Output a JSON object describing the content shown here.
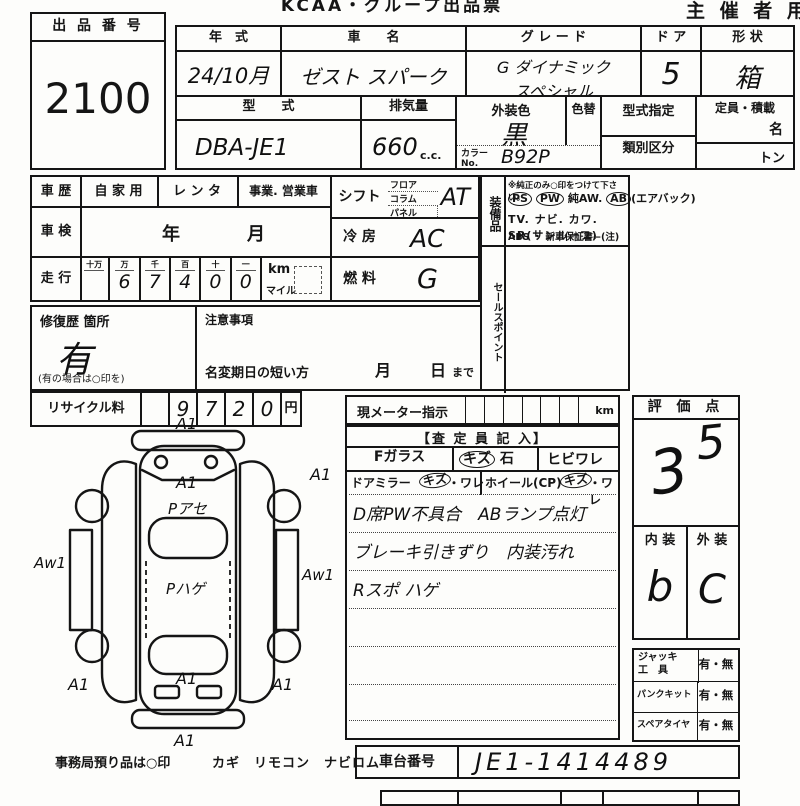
{
  "colors": {
    "ink": "#151515",
    "paper": "#fdfdfb"
  },
  "header": {
    "title": "KCAA・グループ出品票",
    "organizer": "主 催 者 用"
  },
  "lot": {
    "label": "出 品 番 号",
    "number": "2100"
  },
  "top": {
    "year_label": "年　式",
    "year_value": "24/10月",
    "name_label": "車　　名",
    "name_value": "ゼスト スパーク",
    "grade_label": "グ レ ー ド",
    "grade_line1": "G ダイナミック",
    "grade_line2": "スペシャル",
    "door_label": "ド ア",
    "door_value": "5",
    "shape_label": "形 状",
    "shape_value": "箱",
    "model_label": "型　　式",
    "model_value": "DBA-JE1",
    "disp_label": "排気量",
    "disp_value": "660",
    "disp_unit": "c.c.",
    "color_label": "外装色",
    "color_value": "黒",
    "recolor_label": "色替",
    "colorno_label": "カラーNo.",
    "colorno_value": "B92P",
    "typedesig_label": "型式指定",
    "class_label": "類別区分",
    "capacity_label": "定員・積載",
    "capacity_persons": "名",
    "capacity_load": "トン"
  },
  "history": {
    "label": "車 歴",
    "opt1": "自 家 用",
    "opt2": "レ ン タ",
    "opt3": "事業. 営業車"
  },
  "shaken": {
    "label": "車 検",
    "year": "年",
    "month": "月"
  },
  "mileage": {
    "label": "走 行",
    "cols": [
      "十万",
      "万",
      "千",
      "百",
      "十",
      "一"
    ],
    "digits": [
      "",
      "6",
      "7",
      "4",
      "0",
      "0"
    ],
    "km": "km",
    "mile": "マイル"
  },
  "shift": {
    "label": "シフト",
    "opt1": "フロア",
    "opt2": "コラム",
    "opt3": "パネル",
    "value": "AT"
  },
  "cooling": {
    "label": "冷 房",
    "value": "AC"
  },
  "fuel": {
    "label": "燃 料",
    "value": "G"
  },
  "equipment": {
    "label": "装備品",
    "note": "※純正のみ○印をつけて下さい。",
    "ps": "PS",
    "pw": "PW",
    "aw": "純AW.",
    "ab": "AB",
    "ab_suffix": "(エアバック)",
    "line2": "TV. ナビ. カワ. SR(サンルーフ)",
    "line3": "ABS ・ 新車保証書←(注) 後日送りのみ"
  },
  "salespoint": {
    "label": "セールスポイント"
  },
  "repair": {
    "label": "修復歴 箇所",
    "value": "有",
    "note": "(有の場合は○印を)"
  },
  "caution": {
    "label": "注意事項",
    "line": "名変期日の短い方",
    "month": "月",
    "day": "日",
    "suffix": "まで"
  },
  "recycle": {
    "label": "リサイクル料",
    "digits": [
      "9",
      "7",
      "2",
      "0"
    ],
    "unit": "円"
  },
  "meter": {
    "label": "現メーター指示",
    "unit": "km"
  },
  "inspection": {
    "header": "【査 定 員 記 入】",
    "fglass_label": "Fガラス",
    "fglass_opt1a": "キズ",
    "fglass_opt1b": "石",
    "fglass_opt2": "ヒビワレ",
    "mirror_label": "ドアミラー",
    "mirror_opt1": "キズ",
    "mirror_opt2": "・ワレ",
    "wheel_label": "ホイール(CP)",
    "wheel_opt1": "キズ",
    "wheel_opt2": "・ワレ",
    "note1": "D席PW不具合　ABランプ点灯",
    "note2": "ブレーキ引きずり　内装汚れ",
    "note3": "Rスポ ハゲ"
  },
  "score": {
    "label": "評 価 点",
    "value_main": "3",
    "value_sub": "5",
    "interior_label": "内 装",
    "exterior_label": "外 装",
    "interior_value": "b",
    "exterior_value": "C"
  },
  "accessories": {
    "jack_label1": "ジャッキ",
    "jack_label2": "工　具",
    "jack_value": "有・無",
    "kit_label": "パンクキット",
    "kit_value": "有・無",
    "spare_label": "スペアタイヤ",
    "spare_value": "有・無"
  },
  "chassis": {
    "label": "車台番号",
    "value": "JE1-1414489"
  },
  "footer": {
    "office": "事務局預り品は○印",
    "items": "カギ　リモコン　ナビロム"
  },
  "diagram": {
    "front_top": "A1",
    "hood": "A1",
    "hood_paint": "Pアセ",
    "roof": "Pハゲ",
    "front_right": "A1",
    "side_left": "Aw1",
    "side_right": "Aw1",
    "rear_left": "A1",
    "rear_center": "A1",
    "rear_right": "A1",
    "rear_bottom": "A1"
  }
}
